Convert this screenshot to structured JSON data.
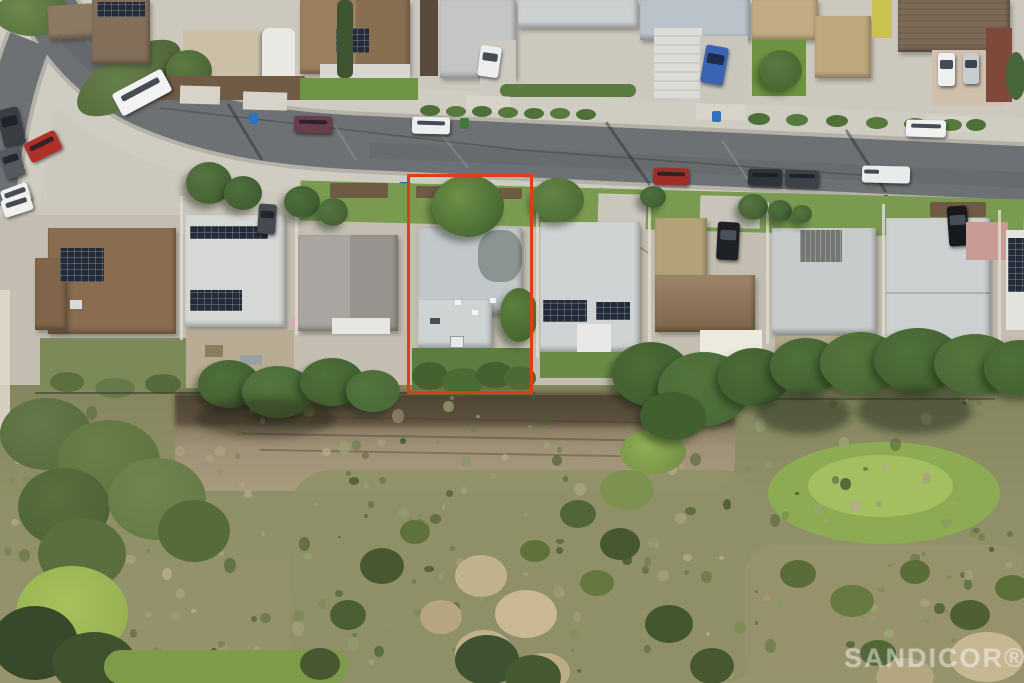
{
  "scene": {
    "type": "aerial-drone-photo",
    "subject": "suburban street of single-family homes backing onto a brush canyon; one canyon-rim parcel outlined in red",
    "width_px": 1024,
    "height_px": 683
  },
  "annotation": {
    "shape": "rectangle",
    "purpose": "highlighted-property-outline",
    "x": 407,
    "y": 174,
    "width": 126,
    "height": 220,
    "stroke_color": "#e03c1a",
    "stroke_px": 3
  },
  "watermark": {
    "text": "SANDICOR®",
    "color": "rgba(255,255,255,0.38)",
    "position": "bottom-right"
  },
  "palette": {
    "asphalt": "#6d7174",
    "concrete": "#cfccc2",
    "curb": "#b4b1a8",
    "lawn": "#7a9a50",
    "tree_dark": "#3e5a2f",
    "tree_light": "#55753c",
    "scrub": "#8f9068",
    "dirt": "#a79a7c",
    "dirt_shadow": "#6e5f49",
    "roof_gray": "#c7cbcb",
    "roof_brown": "#8a6d50",
    "roof_white": "#e8e9e6",
    "solar_panel": "#232c38",
    "annotation_red": "#e03c1a",
    "canyon_speckles": [
      "#6e7c49",
      "#57693a",
      "#8b9468",
      "#a99f7e",
      "#4c5c31",
      "#99a474",
      "#b5a98a",
      "#7d8a55"
    ]
  }
}
